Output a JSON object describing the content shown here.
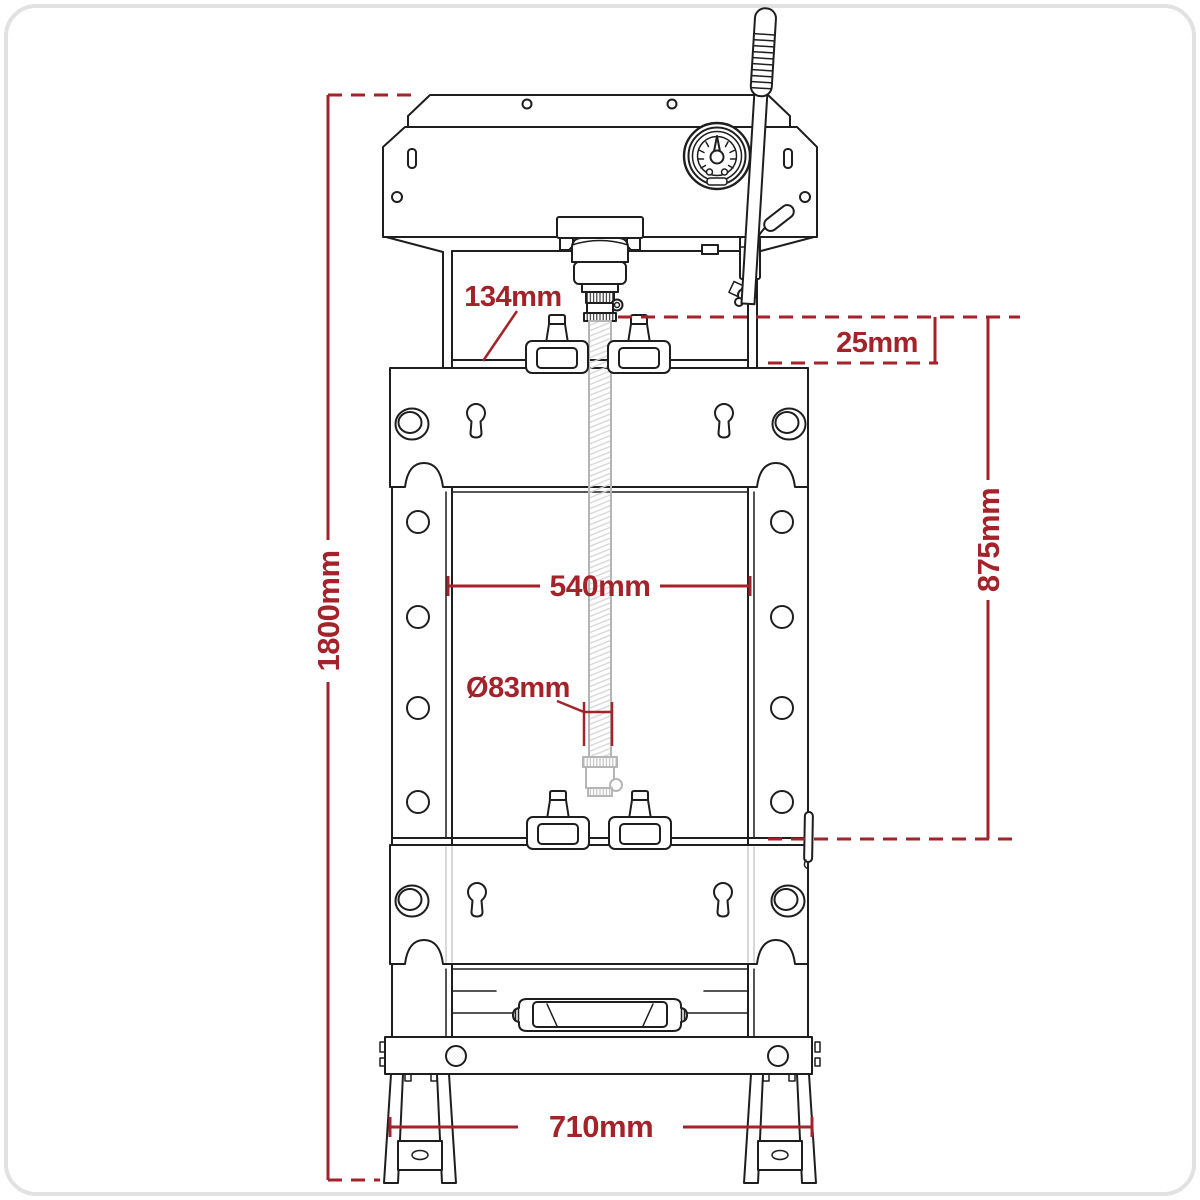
{
  "figure": {
    "kind": "technical-line-drawing",
    "subject": "hydraulic press front view with dimensions"
  },
  "colors": {
    "dimension_accent": "#A4222A",
    "drawing_line": "#1E1E1E",
    "faded_line": "#B5B5B5",
    "card_border": "#E2E2E2",
    "background": "#FFFFFF"
  },
  "dimensions": {
    "overall_height": "1800mm",
    "throat_clearance": "134mm",
    "pin_step_height": "25mm",
    "working_width": "540mm",
    "ram_diameter": "Ø83mm",
    "working_range": "875mm",
    "base_width": "710mm"
  }
}
